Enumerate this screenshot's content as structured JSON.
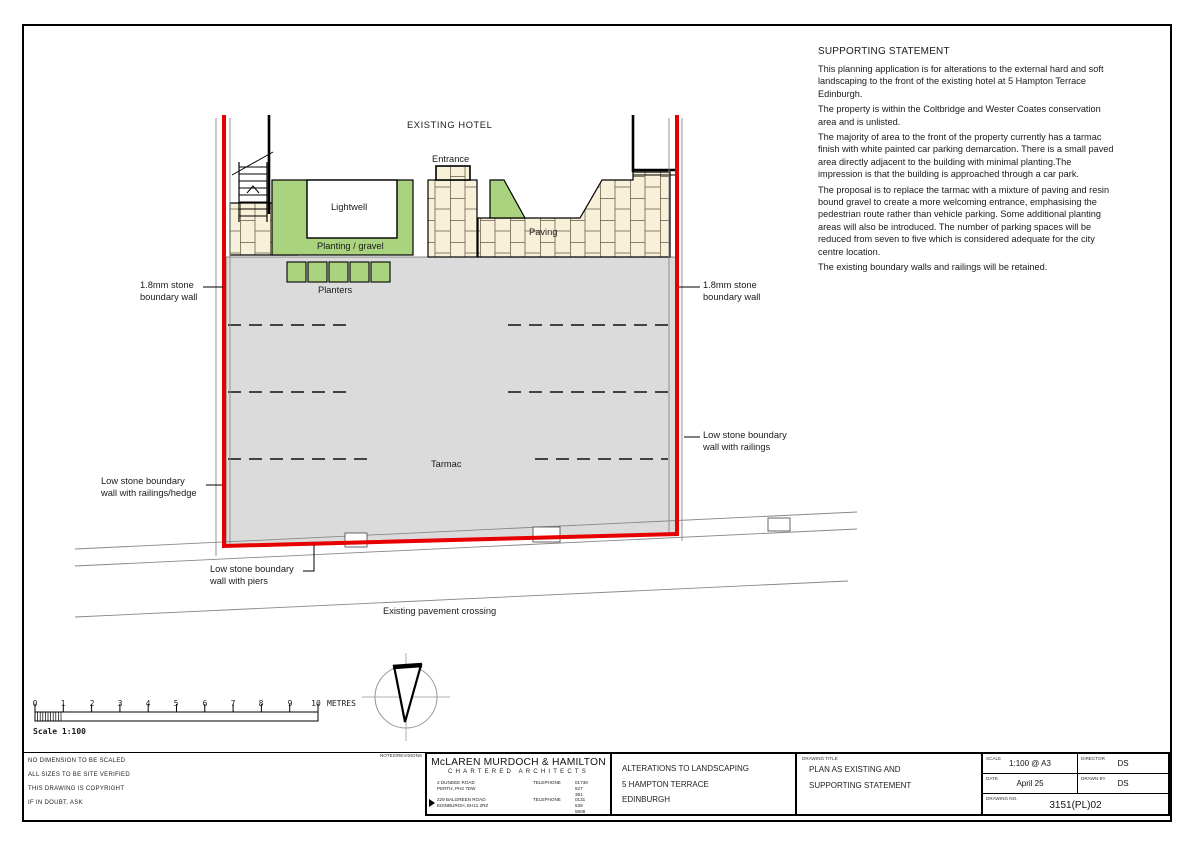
{
  "statement": {
    "title": "SUPPORTING STATEMENT",
    "paragraphs": [
      "This planning application is for alterations to the external hard and soft landscaping to the front of the existing hotel at 5 Hampton Terrace Edinburgh.",
      "The property is within the Coltbridge and Wester Coates conservation area and is unlisted.",
      "The majority of area to the front of the property currently has a tarmac finish with white painted car parking demarcation. There is a small paved area directly adjacent to the building with minimal planting.The impression is that the building is approached through a car park.",
      "The proposal is to replace the tarmac with a mixture of paving and resin bound gravel to create a more welcoming entrance, emphasising the pedestrian route rather than vehicle parking. Some additional planting areas will also be introduced. The number of parking spaces will be reduced from seven to five which is considered adequate for the city centre location.",
      "The existing boundary walls and railings will be retained."
    ]
  },
  "plan": {
    "labels": {
      "existing_hotel": "EXISTING HOTEL",
      "entrance": "Entrance",
      "lightwell": "Lightwell",
      "planting_gravel": "Planting / gravel",
      "paving": "Paving",
      "planters": "Planters",
      "tarmac": "Tarmac"
    },
    "colors": {
      "boundary_red": "#e60000",
      "planting_green": "#a9d37e",
      "paving_cream": "#f8f0d8",
      "tarmac_grey": "#dbdbdb"
    }
  },
  "annotations": {
    "wall_left": [
      "1.8mm stone",
      "boundary wall"
    ],
    "wall_right": [
      "1.8mm stone",
      "boundary wall"
    ],
    "railings_right": [
      "Low stone boundary",
      "wall with railings"
    ],
    "railings_hedge_left": [
      "Low stone boundary",
      "wall with railings/hedge"
    ],
    "piers": [
      "Low stone boundary",
      "wall with piers"
    ],
    "pavement_crossing": "Existing pavement crossing"
  },
  "scale_bar": {
    "labels": [
      "0",
      "1",
      "2",
      "3",
      "4",
      "5",
      "6",
      "7",
      "8",
      "9",
      "10"
    ],
    "unit": "METRES",
    "caption": "Scale 1:100"
  },
  "title_block": {
    "notes_header": "NOTES/REVISIONS",
    "notes": [
      "NO DIMENSION TO BE SCALED",
      "ALL SIZES TO BE SITE VERIFIED",
      "THIS DRAWING IS COPYRIGHT",
      "IF IN DOUBT, ASK"
    ],
    "firm": {
      "name": "McLAREN MURDOCH & HAMILTON",
      "subtitle": "CHARTERED ARCHITECTS",
      "offices": [
        {
          "address1": "2 DUNDEE ROAD",
          "address2": "PERTH, PH2 7DW",
          "phone_label": "TELEPHONE",
          "phone": "01738 627 391"
        },
        {
          "address1": "229 BALGREEN ROAD",
          "address2": "EDINBURGH, EH11 2RZ",
          "phone_label": "TELEPHONE",
          "phone": "0131 539 5808"
        }
      ]
    },
    "project": [
      "ALTERATIONS TO LANDSCAPING",
      "5 HAMPTON TERRACE",
      "EDINBURGH"
    ],
    "drawing_title_label": "DRAWING TITLE",
    "drawing_title": [
      "PLAN AS EXISTING AND",
      "SUPPORTING STATEMENT"
    ],
    "scale_label": "SCALE",
    "scale": "1:100 @ A3",
    "director_label": "DIRECTOR",
    "director": "DS",
    "date_label": "DATE",
    "date": "April 25",
    "drawn_by_label": "DRAWN BY",
    "drawn_by": "DS",
    "drawing_no_label": "DRAWING NO.",
    "drawing_no": "3151(PL)02"
  }
}
